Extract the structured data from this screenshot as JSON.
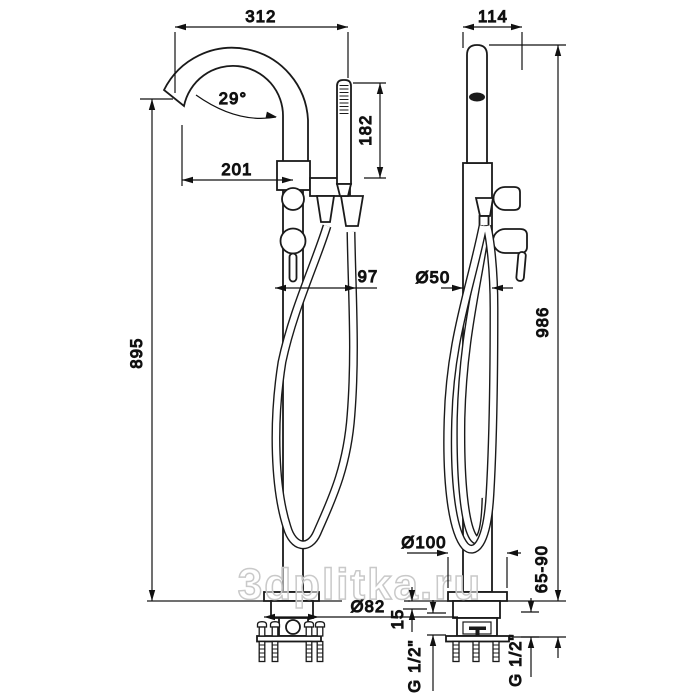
{
  "drawing": {
    "title": "freestanding-bath-mixer-dimension-drawing",
    "watermark": "3dplitka.ru",
    "front_view": {
      "dims": {
        "overall_depth": "312",
        "spout_angle": "29°",
        "spout_reach": "201",
        "handshower_height": "182",
        "hose_offset": "97",
        "outlet_height": "895",
        "base_diameter": "Ø82"
      }
    },
    "side_view": {
      "dims": {
        "top_depth": "114",
        "column_diameter": "Ø50",
        "total_height": "986",
        "floor_flange_diameter": "Ø100",
        "underfloor_range": "65-90",
        "floor_plate": "15",
        "thread_left": "G 1/2\"",
        "thread_right": "G 1/2\""
      }
    }
  }
}
